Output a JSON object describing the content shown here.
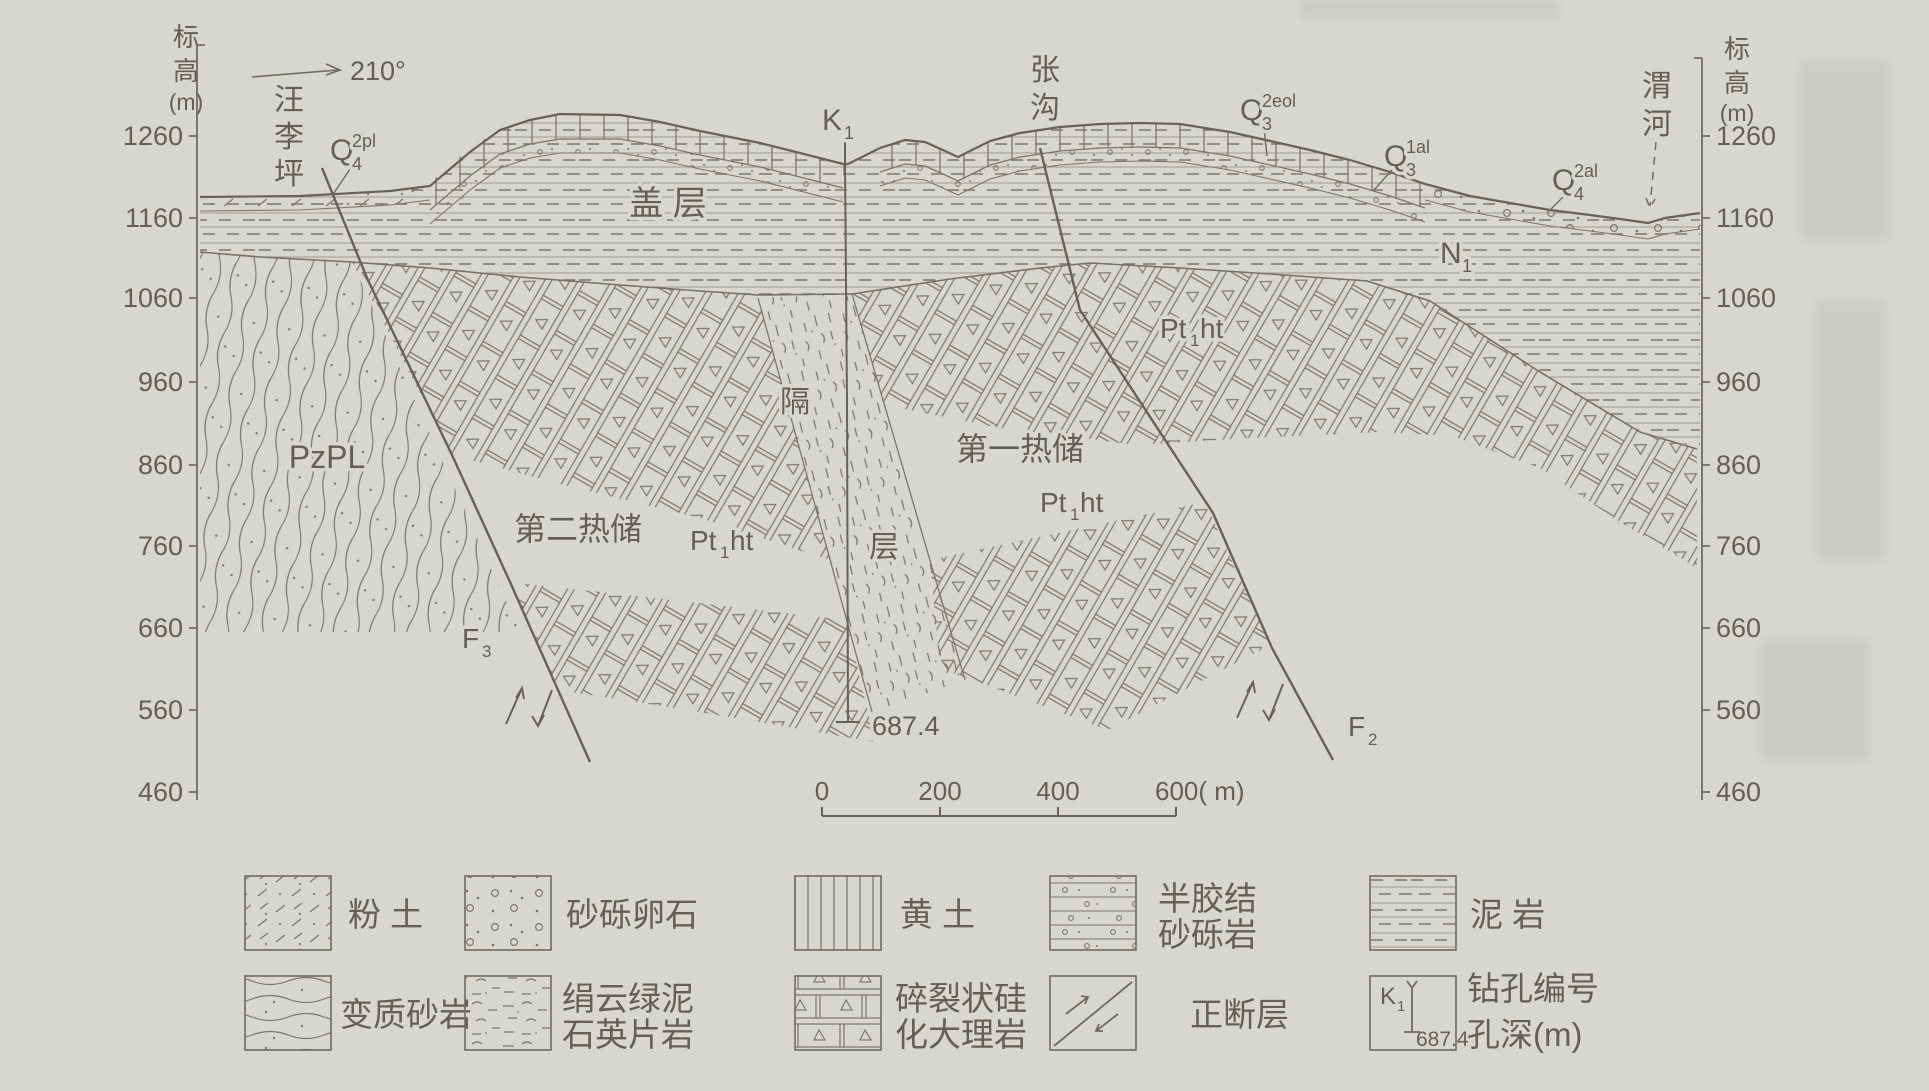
{
  "canvas": {
    "bg": "#d8d6d1",
    "ink": "#7b766d",
    "text": "#635f57"
  },
  "axis": {
    "title": [
      "标",
      "高",
      "(m)"
    ],
    "ticks": [
      "1260",
      "1160",
      "1060",
      "960",
      "860",
      "760",
      "660",
      "560",
      "460"
    ]
  },
  "direction": "210°",
  "places": {
    "left": [
      "汪",
      "李",
      "坪"
    ],
    "middle": [
      "张",
      "沟"
    ],
    "right": [
      "渭",
      "河"
    ]
  },
  "units": {
    "q4_2pl": {
      "base": "Q",
      "sub": "4",
      "sup": "2pl"
    },
    "q3_2eol": {
      "base": "Q",
      "sub": "3",
      "sup": "2eol"
    },
    "q3_1al": {
      "base": "Q",
      "sub": "3",
      "sup": "1al"
    },
    "q4_2al": {
      "base": "Q",
      "sub": "4",
      "sup": "2al"
    },
    "k1": {
      "base": "K",
      "sub": "1"
    },
    "n1": {
      "base": "N",
      "sub": "1"
    },
    "f3": {
      "base": "F",
      "sub": "3"
    },
    "f2": {
      "base": "F",
      "sub": "2"
    },
    "pt1ht": {
      "base": "Pt",
      "sub": "1",
      "tail": "ht"
    },
    "pzpl": "PzPL",
    "cover": "盖  层",
    "reservoir2": "第二热储",
    "reservoir1": "第一热储",
    "isolation": {
      "char1": "隔",
      "char2": "层"
    },
    "borehole_depth": "687.4"
  },
  "scalebar": {
    "t0": "0",
    "t200": "200",
    "t400": "400",
    "t600": "600( m)"
  },
  "legend": {
    "row1": [
      {
        "label": "粉 土",
        "label2": ""
      },
      {
        "label": "砂砾卵石",
        "label2": ""
      },
      {
        "label": "黄 土",
        "label2": ""
      },
      {
        "label": "半胶结",
        "label2": "砂砾岩"
      },
      {
        "label": "泥 岩",
        "label2": ""
      }
    ],
    "row2": [
      {
        "label": "变质砂岩",
        "label2": ""
      },
      {
        "label": "绢云绿泥",
        "label2": "石英片岩"
      },
      {
        "label": "碎裂状硅",
        "label2": "化大理岩"
      },
      {
        "label": "正断层",
        "label2": ""
      },
      {
        "label": "钻孔编号",
        "label2": "孔深(m)"
      }
    ]
  }
}
